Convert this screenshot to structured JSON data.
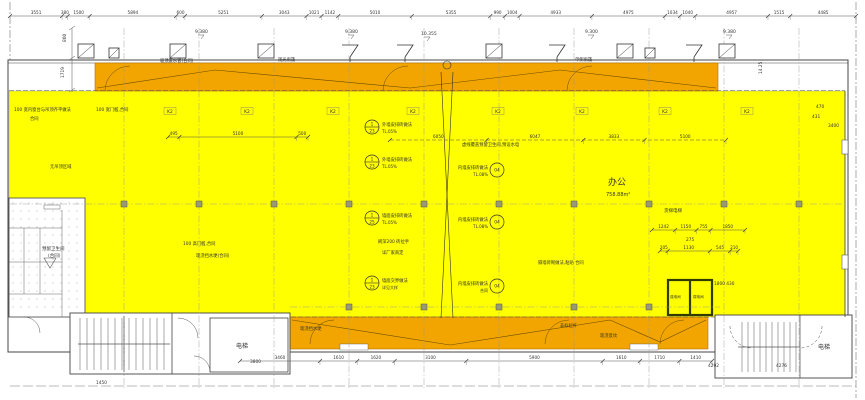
{
  "drawing": {
    "colors": {
      "highlight": "#FFFF00",
      "corridor": "#F2A500",
      "corridor_edge": "#b87400",
      "column": "#9a9a72",
      "wall": "#444444",
      "dark_room_wall": "#2f3b00",
      "line": "#555555"
    },
    "icons": {
      "skylight": "skylight-icon",
      "drain_funnel": "drain-funnel-icon",
      "door_swing": "door-swing-icon",
      "stair": "stair-treads-icon"
    },
    "room_labels": {
      "office": "办公",
      "office_area": "758.88m²",
      "elevator": "电梯",
      "stair_right_room": "电梯",
      "restroom_line1": "预留卫生间",
      "restroom_line2": "(合同)",
      "strong_electric": "强电间",
      "weak_electric": "弱电间",
      "freight_elevator": "货梯电梯"
    },
    "levels": [
      {
        "x": 195,
        "y": 33,
        "t": "9.380"
      },
      {
        "x": 345,
        "y": 33,
        "t": "9.380"
      },
      {
        "x": 421,
        "y": 35,
        "t": "10.355"
      },
      {
        "x": 585,
        "y": 33,
        "t": "9.300"
      },
      {
        "x": 723,
        "y": 33,
        "t": "9.380"
      }
    ],
    "window_tags": {
      "label": "K2",
      "y": 113,
      "xs": [
        170,
        247,
        333,
        413,
        498,
        582,
        665,
        747
      ]
    },
    "chains": [
      {
        "x0": 10,
        "x1": 856,
        "y": 16,
        "values": [
          "3551",
          "380",
          "1500",
          "5894",
          "600",
          "5251",
          "3043",
          "1021",
          "1142",
          "5010",
          "5355",
          "990",
          "1004",
          "4933",
          "4975",
          "1034",
          "1040",
          "4957",
          "1515",
          "4485"
        ]
      },
      {
        "x0": 168,
        "x1": 308,
        "y": 137,
        "values": [
          "495",
          "5100",
          "500"
        ]
      },
      {
        "x0": 390,
        "x1": 726,
        "y": 140,
        "dashed": true,
        "values": [
          "6050",
          "6047",
          "3833",
          "5100"
        ]
      },
      {
        "x0": 652,
        "x1": 745,
        "y": 230,
        "values": [
          "1242",
          "1150",
          "755",
          "1850"
        ]
      },
      {
        "x0": 660,
        "x1": 738,
        "y": 251,
        "values": [
          "205",
          "1130",
          "545",
          "210"
        ]
      },
      {
        "x0": 240,
        "x1": 712,
        "y": 361,
        "values": [
          "3460",
          "1610",
          "1620",
          "3100",
          "5900",
          "1610",
          "1710",
          "1410"
        ]
      }
    ],
    "annotations": [
      {
        "x": 14,
        "y": 111,
        "t": "100 宽内窗台与吊顶齐平做法"
      },
      {
        "x": 30,
        "y": 120,
        "t": "合同"
      },
      {
        "x": 96,
        "y": 111,
        "t": "100 宽门槛,合同"
      },
      {
        "x": 50,
        "y": 168,
        "t": "无吊顶区域"
      },
      {
        "x": 160,
        "y": 62,
        "t": "吸顶废水管(合同)"
      },
      {
        "x": 278,
        "y": 61,
        "t": "观光雨篷"
      },
      {
        "x": 575,
        "y": 61,
        "t": "单侧雨篷"
      },
      {
        "x": 183,
        "y": 245,
        "t": "100 高门槛,合同"
      },
      {
        "x": 196,
        "y": 257,
        "t": "现浇挡水埂(合同)"
      },
      {
        "x": 378,
        "y": 243,
        "t": "刷深200 砖拉手"
      },
      {
        "x": 382,
        "y": 254,
        "t": "详厂家商定"
      },
      {
        "x": 462,
        "y": 146,
        "t": "虚线覆盖预留卫生间,预设水电"
      },
      {
        "x": 538,
        "y": 264,
        "t": "隔墙砖砌做法,粘贴 合同"
      },
      {
        "x": 300,
        "y": 330,
        "t": "现浇挡水埂"
      },
      {
        "x": 560,
        "y": 327,
        "t": "非标栏杆"
      },
      {
        "x": 600,
        "y": 337,
        "t": "现浇反坎"
      },
      {
        "x": 714,
        "y": 285,
        "t": "1800 430"
      },
      {
        "x": 686,
        "y": 241,
        "t": "275"
      },
      {
        "x": 816,
        "y": 108,
        "t": "470"
      },
      {
        "x": 812,
        "y": 118,
        "t": "431"
      },
      {
        "x": 828,
        "y": 127,
        "t": "3400"
      },
      {
        "x": 250,
        "y": 363,
        "t": "3800"
      },
      {
        "x": 96,
        "y": 384,
        "t": "1450"
      },
      {
        "x": 708,
        "y": 367,
        "t": "4292"
      },
      {
        "x": 776,
        "y": 367,
        "t": "4276"
      },
      {
        "x": 66,
        "y": 42,
        "t": "800",
        "rot": -90
      },
      {
        "x": 64,
        "y": 78,
        "t": "1719",
        "rot": -90
      },
      {
        "x": 762,
        "y": 74,
        "t": "14.25",
        "rot": -90
      }
    ],
    "callouts": [
      {
        "x": 372,
        "y": 127,
        "a": "1",
        "b": "23",
        "t": "外墙皮排砖做法",
        "s": "TL.05%",
        "side": "right"
      },
      {
        "x": 372,
        "y": 162,
        "a": "1",
        "b": "23",
        "t": "外墙皮排砖做法",
        "s": "TL.05%",
        "side": "right"
      },
      {
        "x": 497,
        "y": 170,
        "a": "04",
        "t": "内墙皮排砖做法",
        "s": "TL.08%",
        "side": "left"
      },
      {
        "x": 372,
        "y": 218,
        "a": "1",
        "b": "25",
        "t": "墙面皮排砖做法",
        "s": "TL.05%",
        "side": "right"
      },
      {
        "x": 497,
        "y": 222,
        "a": "04",
        "t": "内墙皮排砖做法",
        "s": "TL.08%",
        "side": "left"
      },
      {
        "x": 372,
        "y": 283,
        "a": "1",
        "b": "23",
        "t": "墙面交界做法",
        "s": "详见大样",
        "side": "right"
      },
      {
        "x": 497,
        "y": 286,
        "a": "04",
        "t": "内墙皮排砖做法",
        "s": "合同",
        "side": "left"
      }
    ]
  }
}
